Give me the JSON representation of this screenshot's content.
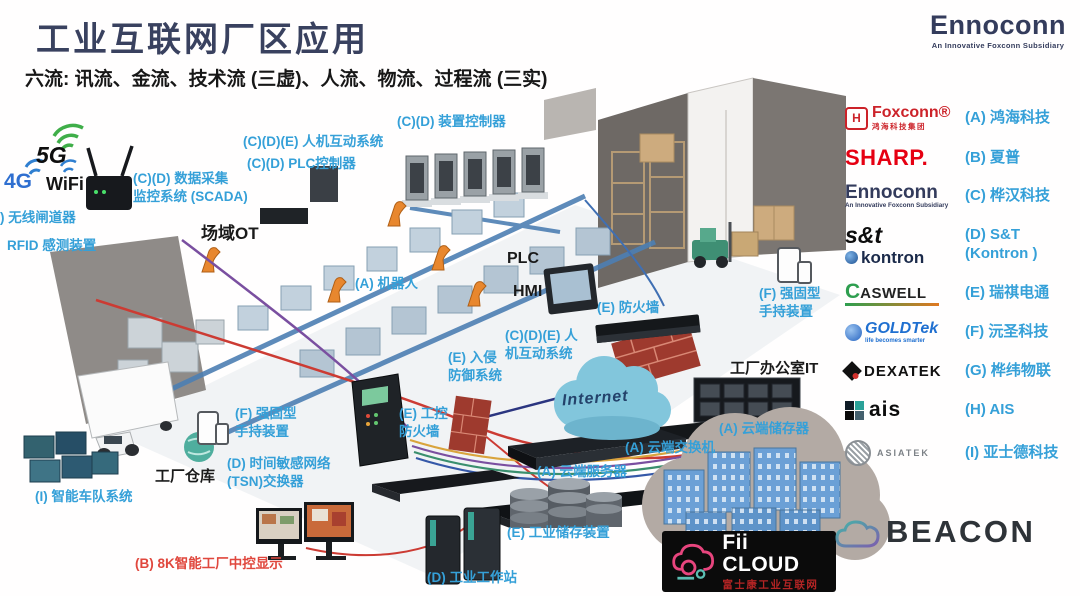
{
  "header": {
    "title": "工业互联网厂区应用",
    "subtitle": "六流: 讯流、金流、技术流 (三虚)、人流、物流、过程流 (三实)",
    "brand": {
      "name": "Ennoconn",
      "tagline": "An Innovative Foxconn Subsidiary"
    }
  },
  "wireless": {
    "g5": "5G",
    "g4": "4G",
    "wifi": "WiFi"
  },
  "diagram": {
    "internet": "Internet",
    "labels": [
      {
        "lines": [
          "(C)(D) 数据采集",
          "监控系统 (SCADA)"
        ],
        "x": 133,
        "y": 170,
        "color": "blue"
      },
      {
        "lines": [
          "(C)(D)(E) 人机互动系统"
        ],
        "x": 243,
        "y": 133,
        "color": "blue"
      },
      {
        "lines": [
          "(C)(D) PLC控制器"
        ],
        "x": 247,
        "y": 155,
        "color": "blue"
      },
      {
        "lines": [
          "(C)(D) 装置控制器"
        ],
        "x": 397,
        "y": 113,
        "color": "blue"
      },
      {
        "lines": [
          ") 无线闸道器"
        ],
        "x": 0,
        "y": 209,
        "color": "blue"
      },
      {
        "lines": [
          "RFID 感测装置"
        ],
        "x": 7,
        "y": 237,
        "color": "blue"
      },
      {
        "lines": [
          "场域OT"
        ],
        "x": 201,
        "y": 223,
        "color": "black",
        "size": 17
      },
      {
        "lines": [
          "PLC"
        ],
        "x": 507,
        "y": 249,
        "color": "black",
        "size": 16
      },
      {
        "lines": [
          "HMI"
        ],
        "x": 513,
        "y": 282,
        "color": "black",
        "size": 16
      },
      {
        "lines": [
          "(A) 机器人"
        ],
        "x": 355,
        "y": 275,
        "color": "blue"
      },
      {
        "lines": [
          "(E) 防火墙"
        ],
        "x": 597,
        "y": 299,
        "color": "blue"
      },
      {
        "lines": [
          "(C)(D)(E) 人",
          "机互动系统"
        ],
        "x": 505,
        "y": 327,
        "color": "blue"
      },
      {
        "lines": [
          "(E) 入侵",
          "防御系统"
        ],
        "x": 448,
        "y": 349,
        "color": "blue"
      },
      {
        "lines": [
          "(F) 强固型",
          "手持装置"
        ],
        "x": 759,
        "y": 285,
        "color": "blue"
      },
      {
        "lines": [
          "工厂办公室IT"
        ],
        "x": 730,
        "y": 359,
        "color": "black",
        "size": 15
      },
      {
        "lines": [
          "(A) 云端储存器"
        ],
        "x": 719,
        "y": 420,
        "color": "blue"
      },
      {
        "lines": [
          "(A) 云端交换机"
        ],
        "x": 625,
        "y": 439,
        "color": "blue"
      },
      {
        "lines": [
          "(A) 云端服务器"
        ],
        "x": 537,
        "y": 463,
        "color": "blue"
      },
      {
        "lines": [
          "(E) 工业储存装置"
        ],
        "x": 507,
        "y": 524,
        "color": "blue"
      },
      {
        "lines": [
          "(D) 工业工作站"
        ],
        "x": 427,
        "y": 569,
        "color": "blue"
      },
      {
        "lines": [
          "(E) 工控",
          "防火墙"
        ],
        "x": 399,
        "y": 405,
        "color": "blue"
      },
      {
        "lines": [
          "(F) 强固型",
          "手持装置"
        ],
        "x": 235,
        "y": 405,
        "color": "blue"
      },
      {
        "lines": [
          "(D) 时间敏感网络",
          "(TSN)交换器"
        ],
        "x": 227,
        "y": 455,
        "color": "blue"
      },
      {
        "lines": [
          "工厂仓库"
        ],
        "x": 155,
        "y": 467,
        "color": "black",
        "size": 15
      },
      {
        "lines": [
          "(I) 智能车队系统"
        ],
        "x": 35,
        "y": 488,
        "color": "blue"
      },
      {
        "lines": [
          "(B) 8K智能工厂中控显示"
        ],
        "x": 135,
        "y": 555,
        "color": "red"
      }
    ]
  },
  "legend": {
    "entries": [
      {
        "id": "foxconn",
        "label": "(A) 鸿海科技",
        "logo": {
          "mark": "H",
          "main": "Foxconn®",
          "sub": "鸿海科技集团"
        }
      },
      {
        "id": "sharp",
        "label": "(B) 夏普",
        "logo": {
          "main": "SHARP."
        }
      },
      {
        "id": "ennoconn",
        "label": "(C) 桦汉科技",
        "logo": {
          "main": "Ennoconn",
          "sub": "An Innovative Foxconn Subsidiary"
        }
      },
      {
        "id": "snt",
        "label": "(D) S&T",
        "label2": "(Kontron )",
        "logo": {
          "main": "s&t",
          "sub": "kontron"
        }
      },
      {
        "id": "caswell",
        "label": "(E) 瑞祺电通",
        "logo": {
          "main": "CASWELL"
        }
      },
      {
        "id": "goldtek",
        "label": "(F) 沅圣科技",
        "logo": {
          "main": "GOLDTek",
          "sub": "life becomes smarter"
        }
      },
      {
        "id": "dexatek",
        "label": "(G) 桦纬物联",
        "logo": {
          "main": "DEXATEK"
        }
      },
      {
        "id": "ais",
        "label": "(H) AIS",
        "logo": {
          "main": "ais"
        }
      },
      {
        "id": "asiatek",
        "label": "(I) 亚士德科技",
        "logo": {
          "main": "ASIATEK"
        }
      }
    ]
  },
  "footer": {
    "fii_cloud": {
      "title": "Fii CLOUD",
      "subtitle": "富士康工业互联网"
    },
    "beacon": "BEACON"
  },
  "colors": {
    "label_blue": "#35a0d8",
    "label_red": "#e0473d",
    "title_navy": "#39415f",
    "foxconn_red": "#cc2229",
    "sharp_red": "#e60012",
    "goldtek_blue": "#1f6fd0",
    "caswell_green": "#2e9e4f"
  }
}
